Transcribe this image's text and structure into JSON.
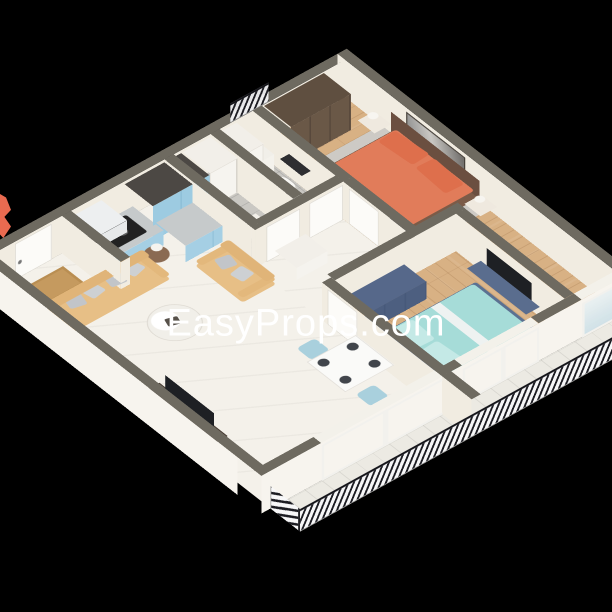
{
  "scene": {
    "type": "3d-isometric-floorplan-render",
    "background": "#000000"
  },
  "watermark": {
    "text": "EasyProps.com",
    "color": "#ffffff"
  },
  "rooms": [
    {
      "name": "living-room",
      "floor_color": "#f4f1ea"
    },
    {
      "name": "kitchen",
      "floor_color": "#f4f1ea",
      "cabinet_color": "#a5cfe4"
    },
    {
      "name": "hallway",
      "floor_color": "#f4f1ea"
    },
    {
      "name": "bathroom",
      "floor_color": "#cac8c3"
    },
    {
      "name": "master-bedroom",
      "floor_color": "#d8b184",
      "bedding_color": "#e17c5a"
    },
    {
      "name": "second-bedroom",
      "floor_color": "#d8b184",
      "bedding_color": "#a6dcd8"
    },
    {
      "name": "balcony",
      "floor_color": "#eceae3"
    }
  ],
  "palette": {
    "wall_top": "#6e6a60",
    "wall_face": "#f1ece1",
    "sofa": "#e7bf86",
    "pillow_gray": "#c2c5c9",
    "kitchen_blue": "#a5cfe4",
    "counter_gray": "#c6cacb",
    "wardrobe_brown": "#6a5847",
    "bed1_duvet": "#e17c5a",
    "bed2_mattress": "#a6dcd8",
    "bed2_frame": "#5b7191",
    "tv_dark": "#1e2024",
    "door_white": "#fcfbf8",
    "railing_dark": "#1c1c22",
    "logo_fragment": "#e96a50"
  }
}
